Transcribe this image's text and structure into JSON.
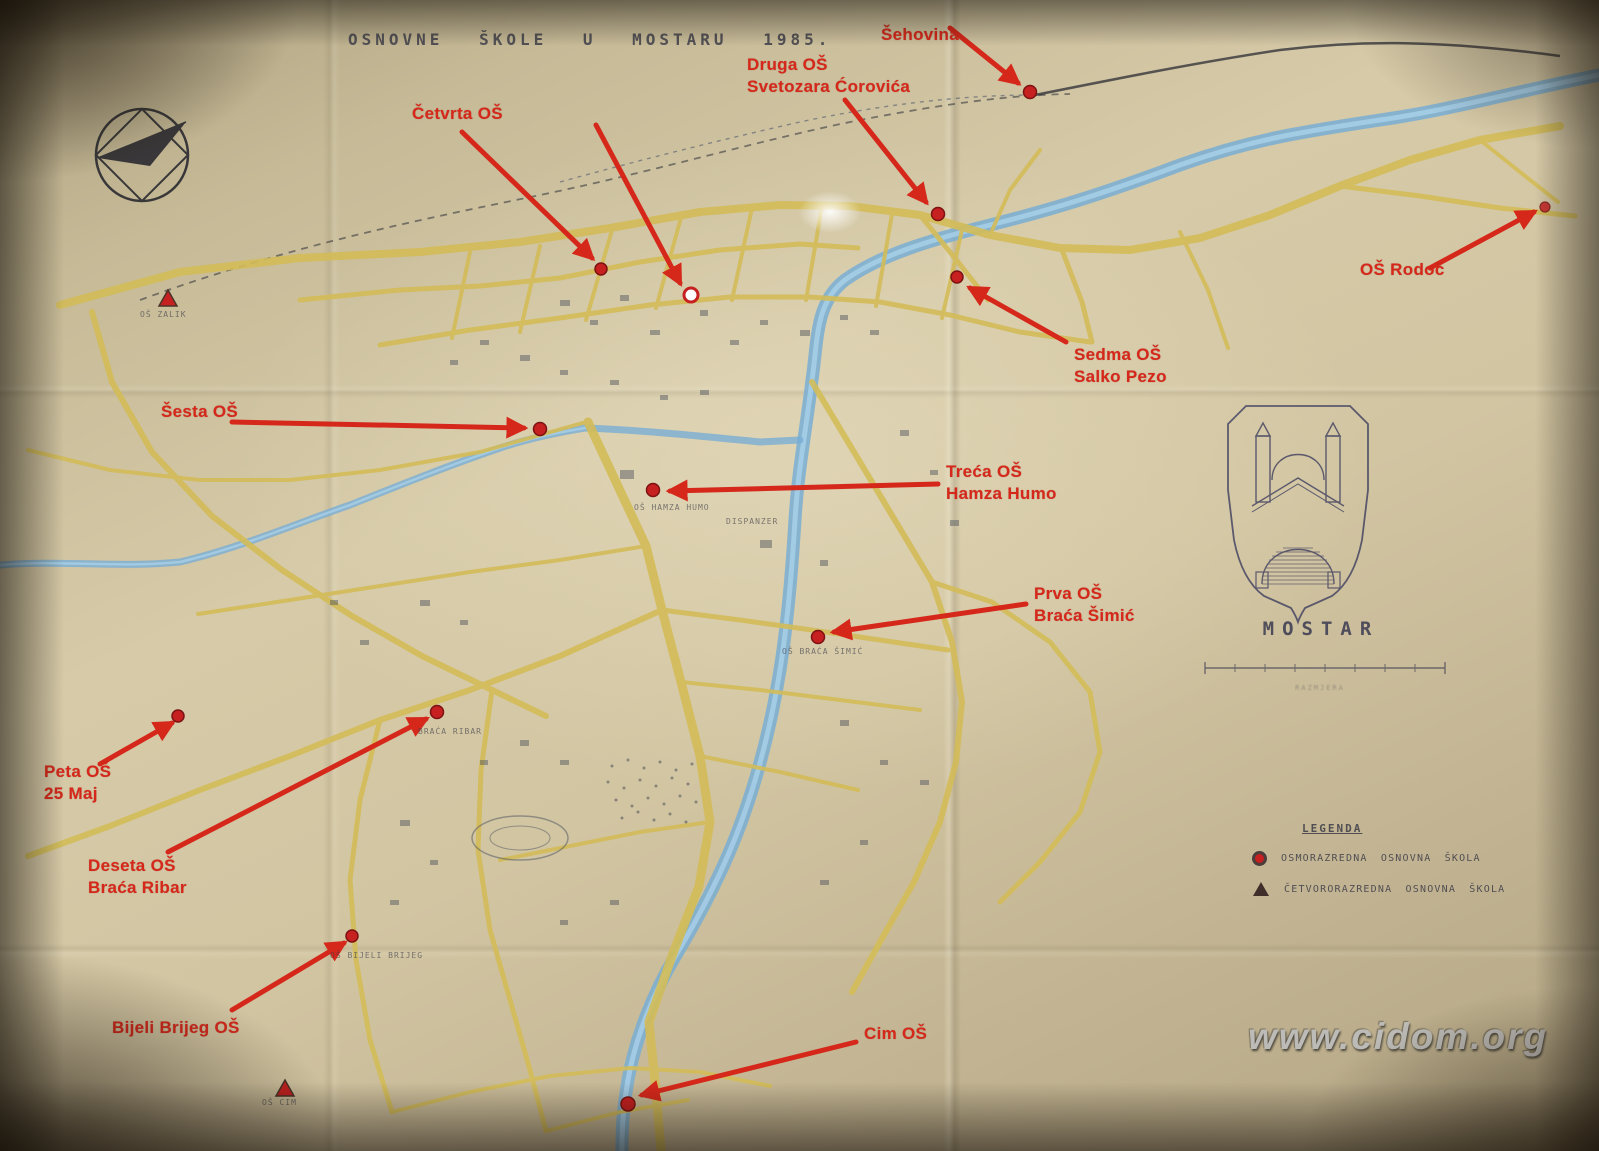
{
  "title": "OSNOVNE ŠKOLE U MOSTARU 1985.",
  "watermark": "www.cidom.org",
  "emblem_caption": "MOSTAR",
  "scale_caption": "RAZMJERA",
  "legend": {
    "heading": "LEGENDA",
    "items": [
      {
        "icon": "eight-grade-school-marker",
        "label": "OSMORAZREDNA OSNOVNA ŠKOLA"
      },
      {
        "icon": "four-grade-school-marker",
        "label": "ČETVORORAZREDNA OSNOVNA ŠKOLA"
      }
    ]
  },
  "annotations": [
    {
      "name": "sehovina",
      "lines": [
        "Šehovina"
      ]
    },
    {
      "name": "druga-os",
      "lines": [
        "Druga OŠ",
        "Svetozara Ćorovića"
      ]
    },
    {
      "name": "cetvrta-os",
      "lines": [
        "Četvrta OŠ"
      ]
    },
    {
      "name": "os-rodoc",
      "lines": [
        "OŠ Rodoč"
      ]
    },
    {
      "name": "sedma-os",
      "lines": [
        "Sedma OŠ",
        "Salko Pezo"
      ]
    },
    {
      "name": "sesta-os",
      "lines": [
        "Šesta OŠ"
      ]
    },
    {
      "name": "treca-os",
      "lines": [
        "Treća OŠ",
        "Hamza Humo"
      ]
    },
    {
      "name": "prva-os",
      "lines": [
        "Prva OŠ",
        "Braća Šimić"
      ]
    },
    {
      "name": "peta-os",
      "lines": [
        "Peta OŠ",
        "25 Maj"
      ]
    },
    {
      "name": "deseta-os",
      "lines": [
        "Deseta OŠ",
        "Braća Ribar"
      ]
    },
    {
      "name": "bijeli-brijeg",
      "lines": [
        "Bijeli Brijeg OŠ"
      ]
    },
    {
      "name": "cim-os",
      "lines": [
        "Cim OŠ"
      ]
    }
  ],
  "map_labels": [
    {
      "text": "OŠ ZALIK"
    },
    {
      "text": "OŠ HAMZA HUMO"
    },
    {
      "text": "DISPANZER"
    },
    {
      "text": "OŠ BRAĆA ŠIMIĆ"
    },
    {
      "text": "BRAĆA RIBAR"
    },
    {
      "text": "OŠ BIJELI BRIJEG"
    },
    {
      "text": "OŠ CIM"
    }
  ],
  "colors": {
    "annotation_red": "#d5281b",
    "marker_red": "#c62020",
    "road_yellow": "#d3bc58",
    "river_blue": "#8cbede",
    "paper": "#d2c5a2",
    "ink": "#3c3c48"
  }
}
